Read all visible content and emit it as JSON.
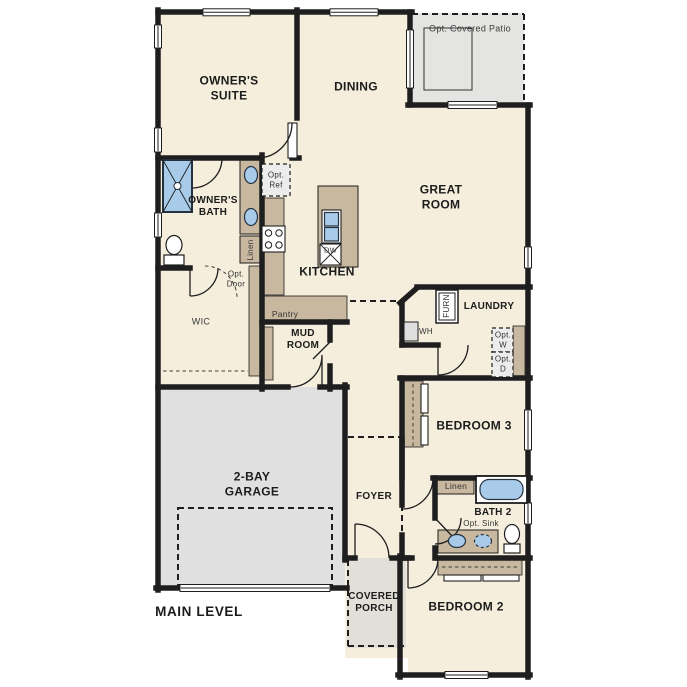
{
  "title": "MAIN LEVEL",
  "rooms": {
    "owners_suite": "OWNER'S SUITE",
    "dining": "DINING",
    "great_room": "GREAT ROOM",
    "owners_bath": "OWNER'S BATH",
    "wic": "WIC",
    "kitchen": "KITCHEN",
    "mud_room": "MUD ROOM",
    "foyer": "FOYER",
    "laundry": "LAUNDRY",
    "bedroom3": "BEDROOM 3",
    "bath2": "BATH 2",
    "bedroom2": "BEDROOM 2",
    "garage": "2-BAY GARAGE",
    "covered_porch": "COVERED PORCH"
  },
  "features": {
    "opt_covered_patio": "Opt. Covered Patio",
    "opt_ref": "Opt. Ref",
    "linen_owners_bath": "Linen",
    "opt_door": "Opt. Door",
    "pantry": "Pantry",
    "dishwasher": "DW",
    "water_heater": "WH",
    "furnace": "FURN",
    "opt_washer": "Opt. W",
    "opt_dryer": "Opt. D",
    "linen_bath2": "Linen",
    "opt_sink": "Opt. Sink"
  },
  "colors": {
    "floor": "#f5eedd",
    "wall": "#1e1e1e",
    "cabinet": "#c9b8a0",
    "garage_floor": "#e0e0e0",
    "patio_floor": "#e4e4e2",
    "porch_floor": "#e2dfd8",
    "fixture_blue": "#a9cbea",
    "appliance_gray": "#dedede"
  }
}
